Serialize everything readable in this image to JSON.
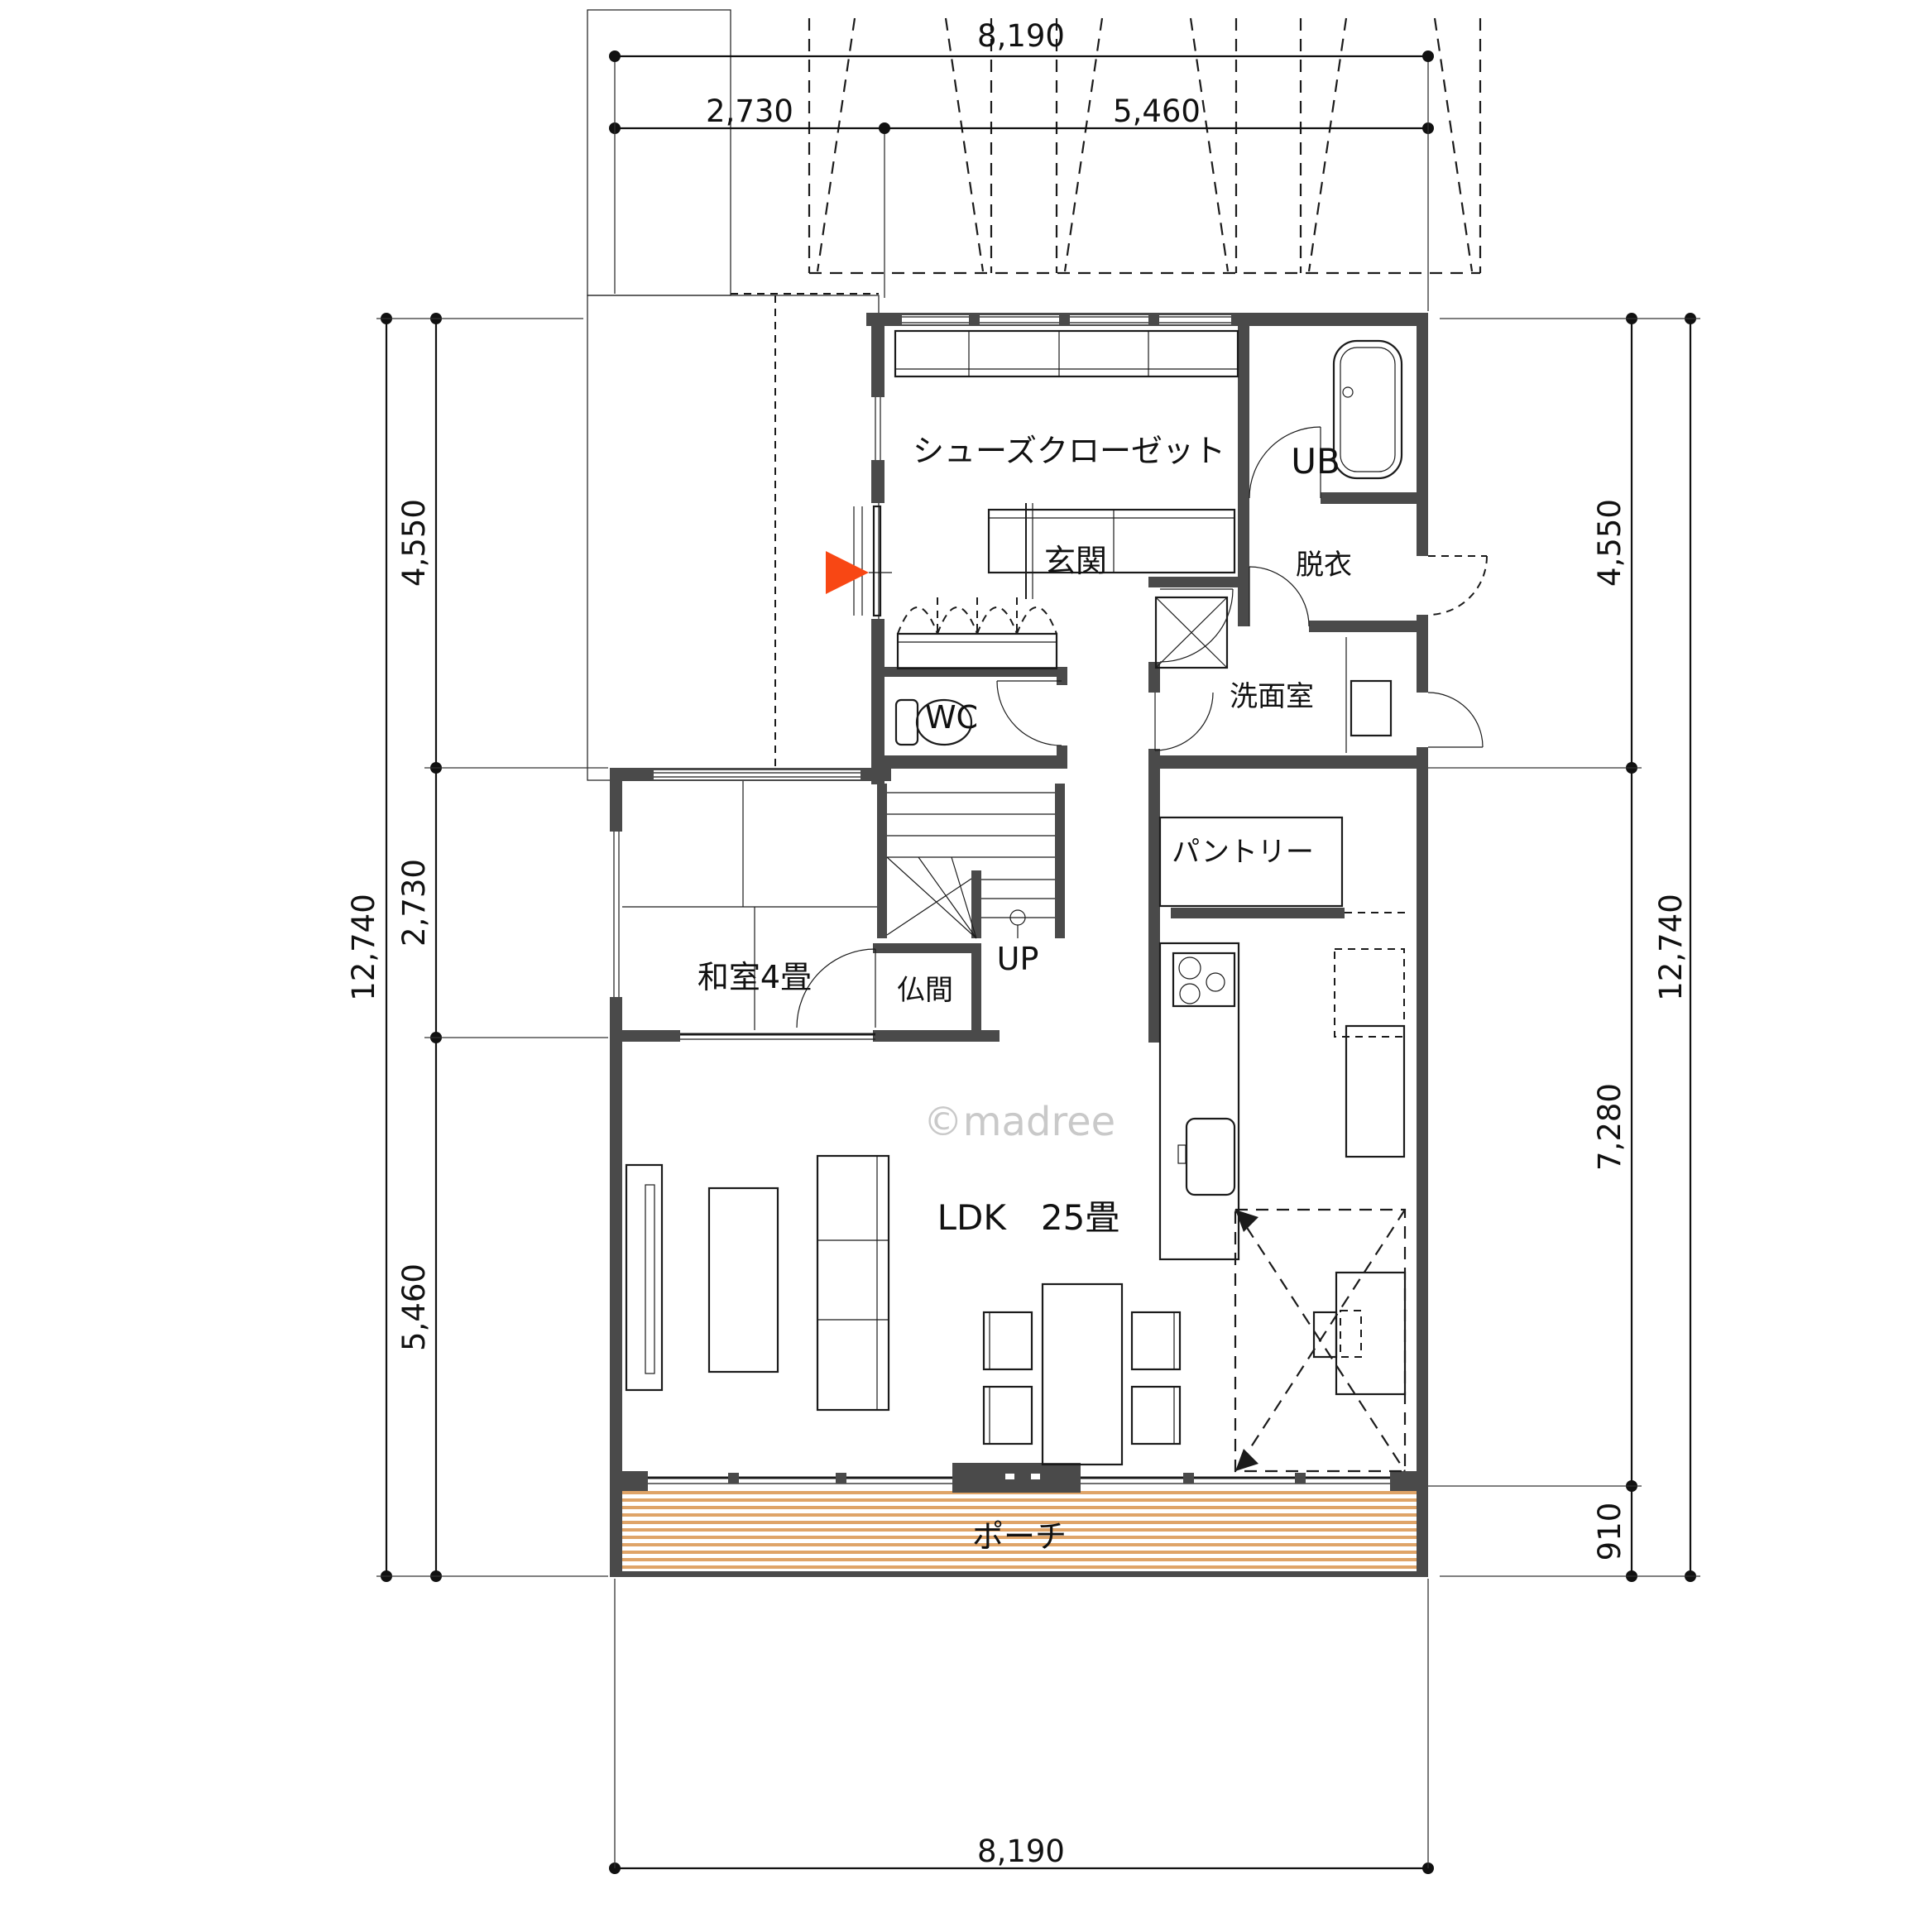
{
  "title": "1F間取り図",
  "watermark": "©madree",
  "colors": {
    "wall": "#4a4a4a",
    "accent_arrow": "#f84714",
    "porch_stripe": "#dfa468",
    "watermark": "#c9c9c9"
  },
  "dimensions": {
    "top_total": "8,190",
    "top_seg1": "2,730",
    "top_seg2": "5,460",
    "bottom_total": "8,190",
    "left_total": "12,740",
    "left_seg1": "4,550",
    "left_seg2": "2,730",
    "left_seg3": "5,460",
    "right_seg1": "4,550",
    "right_seg2": "7,280",
    "right_seg3": "910",
    "right_total": "12,740"
  },
  "rooms": {
    "shoe_closet": "シューズクローゼット",
    "unit_bath": "UB",
    "entrance": "玄関",
    "dressing": "脱衣",
    "washroom": "洗面室",
    "toilet": "WC",
    "japanese_room": "和室4畳",
    "altar_room": "仏間",
    "pantry": "パントリー",
    "ldk": "LDK　25畳",
    "porch": "ポーチ",
    "stairs_up": "UP"
  }
}
